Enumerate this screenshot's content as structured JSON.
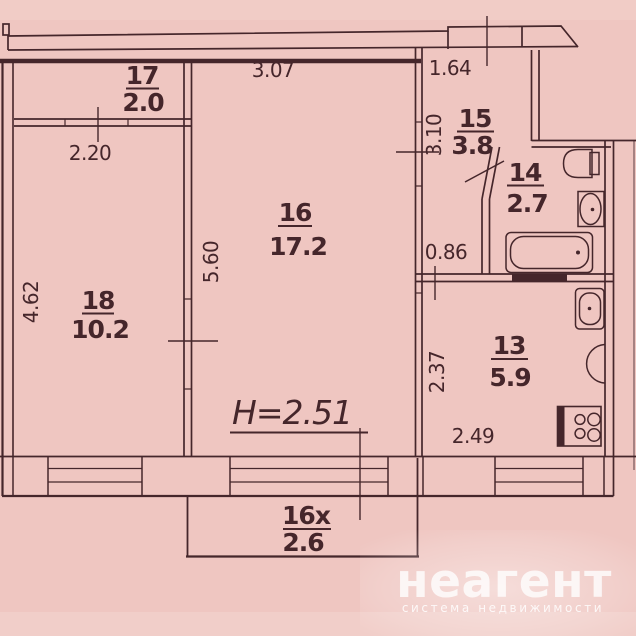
{
  "plan": {
    "rooms": [
      {
        "number": "17",
        "area": "2.0"
      },
      {
        "number": "16",
        "area": "17.2"
      },
      {
        "number": "18",
        "area": "10.2"
      },
      {
        "number": "15",
        "area": "3.8"
      },
      {
        "number": "14",
        "area": "2.7"
      },
      {
        "number": "13",
        "area": "5.9"
      },
      {
        "number": "16x",
        "area": "2.6"
      }
    ],
    "dimensions": {
      "room16_width": "3.07",
      "hall_width": "1.64",
      "room17_width": "2.20",
      "hall_depth": "3.10",
      "room16_depth": "5.60",
      "room18_depth": "4.62",
      "hall_lower_width": "0.86",
      "kitchen_depth": "2.37",
      "kitchen_width": "2.49"
    },
    "ceiling_height_label": "H=2.51"
  },
  "watermark": {
    "brand": "неагент",
    "tagline": "система недвижимости"
  },
  "colors": {
    "paper": "#efc6c1",
    "ink": "#45262b",
    "watermark": "#ffffff"
  }
}
